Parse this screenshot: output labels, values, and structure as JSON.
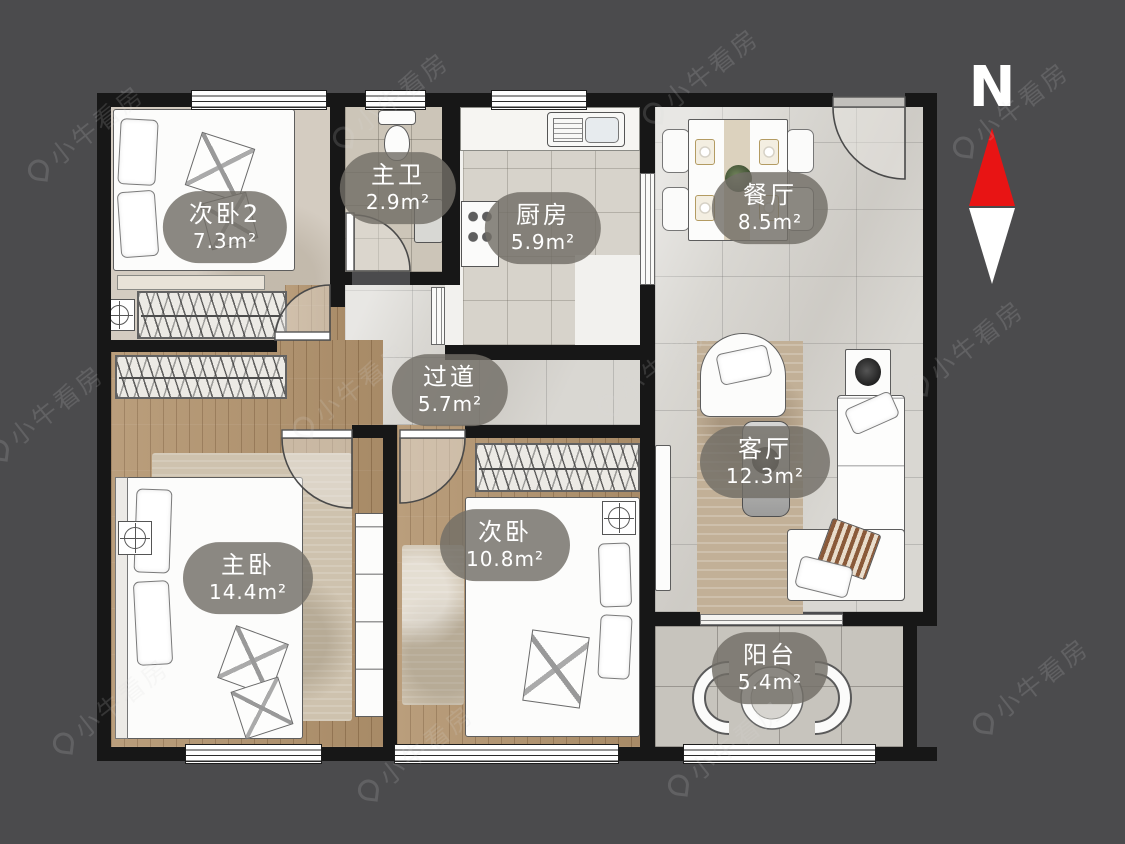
{
  "compass": {
    "label": "N"
  },
  "watermark": {
    "text": "小牛看房"
  },
  "colors": {
    "background": "#4b4b4d",
    "wall": "#171717",
    "label_pill": "rgba(113,110,103,0.82)",
    "compass_red": "#e81414",
    "compass_white": "#ffffff"
  },
  "rooms": [
    {
      "name": "次卧2",
      "area": "7.3m²"
    },
    {
      "name": "主卫",
      "area": "2.9m²"
    },
    {
      "name": "厨房",
      "area": "5.9m²"
    },
    {
      "name": "餐厅",
      "area": "8.5m²"
    },
    {
      "name": "过道",
      "area": "5.7m²"
    },
    {
      "name": "客厅",
      "area": "12.3m²"
    },
    {
      "name": "主卧",
      "area": "14.4m²"
    },
    {
      "name": "次卧",
      "area": "10.8m²"
    },
    {
      "name": "阳台",
      "area": "5.4m²"
    }
  ]
}
